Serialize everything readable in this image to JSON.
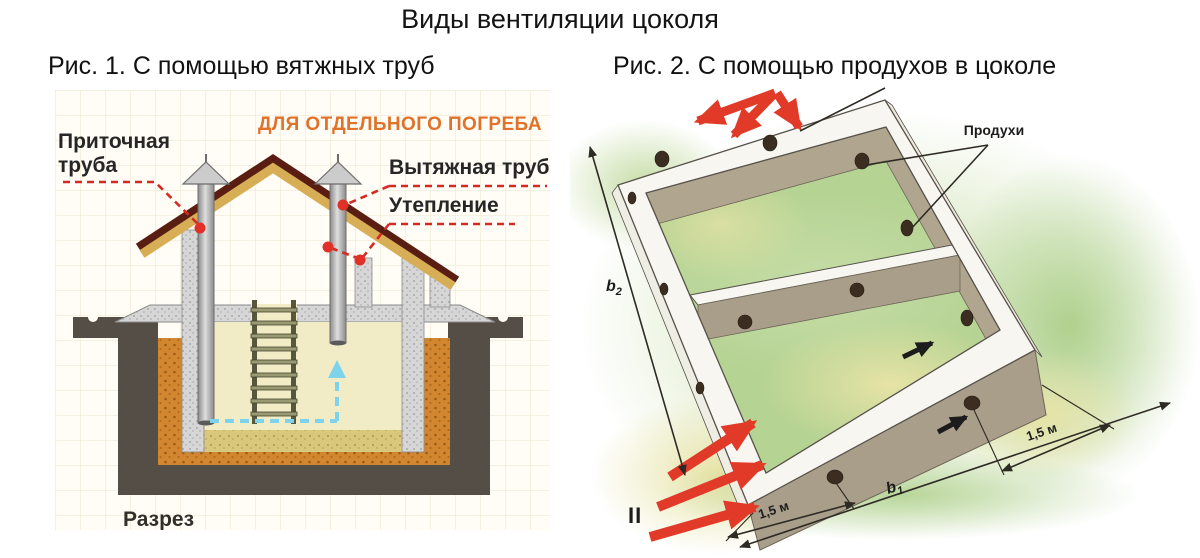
{
  "title": "Виды вентиляции цоколя",
  "fig1": {
    "caption": "Рис. 1. С помощью вятжных труб",
    "heading": "ДЛЯ ОТДЕЛЬНОГО ПОГРЕБА",
    "labels": {
      "supply_line1": "Приточная",
      "supply_line2": "труба",
      "exhaust": "Вытяжная труба",
      "insulation": "Утепление",
      "section": "Разрез"
    },
    "colors": {
      "heading": "#e0722c",
      "ground": "#554e47",
      "insulation": "#d2862f",
      "roof": "#d7ad55",
      "roof_edge": "#5a1d12",
      "leader": "#d32b24",
      "airflow": "#7ed3ec"
    }
  },
  "fig2": {
    "caption": "Рис. 2. С помощью продухов в цоколе",
    "labels": {
      "vents": "Продухи",
      "dim_b": "b",
      "dim_b1_sub": "1",
      "dim_b2_sub": "2",
      "dim_left": "1,5 м",
      "dim_right": "1,5 м",
      "inflow": "II"
    },
    "colors": {
      "concrete_top": "#f7f6f0",
      "concrete_face": "#a89e8a",
      "grass": "#bcd79a",
      "vent": "#3b2e20",
      "arrow": "#e23a28",
      "dimension": "#2e2a24"
    }
  }
}
